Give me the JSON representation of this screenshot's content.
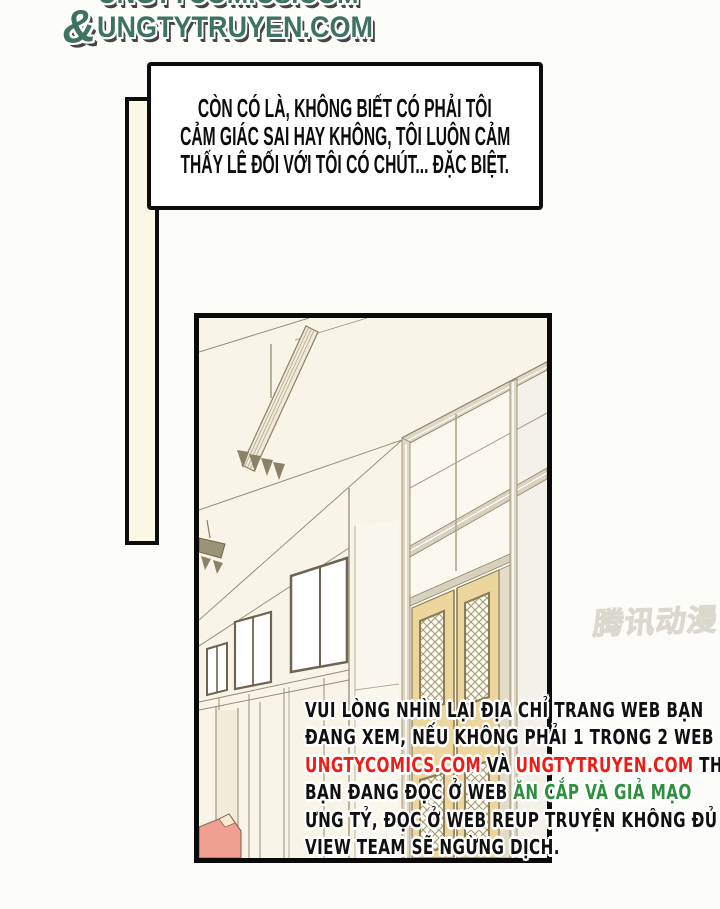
{
  "site_logo": {
    "top_line_partial": "UNGTYCOMICS.COM",
    "ampersand": "&",
    "main_line": "UNGTYTRUYEN.COM",
    "color": "#3e7262"
  },
  "speech_bubble": {
    "lines": [
      "CÒN CÓ LÀ, KHÔNG BIẾT CÓ PHẢI TÔI",
      "CẢM GIÁC SAI HAY KHÔNG, TÔI LUÔN CẢM",
      "THẤY LÊ ĐỐI VỚI TÔI CÓ CHÚT... ĐẶC BIỆT."
    ]
  },
  "artwork": {
    "watermark": "腾讯动漫",
    "wall_color": "#f8f5e8",
    "door_color": "#ecd69e",
    "floor_color": "#f0a090",
    "line_color": "#978d75"
  },
  "warning": {
    "lines": [
      {
        "segments": [
          {
            "text": "VUI LÒNG NHÌN LẠI ĐỊA CHỈ TRANG WEB BẠN",
            "color": "#101010"
          }
        ]
      },
      {
        "segments": [
          {
            "text": "ĐANG XEM, NẾU KHÔNG PHẢI 1 TRONG 2 WEB",
            "color": "#101010"
          }
        ]
      },
      {
        "segments": [
          {
            "text": "UNGTYCOMICS.COM",
            "color": "#ed1c16"
          },
          {
            "text": " VÀ ",
            "color": "#101010"
          },
          {
            "text": "UNGTYTRUYEN.COM",
            "color": "#ed1c16"
          },
          {
            "text": " THÌ",
            "color": "#101010"
          }
        ]
      },
      {
        "segments": [
          {
            "text": "BẠN ĐANG ĐỌC Ở WEB ",
            "color": "#101010"
          },
          {
            "text": "ĂN CẮP VÀ GIẢ MẠO",
            "color": "#2f8f3f"
          }
        ]
      },
      {
        "segments": [
          {
            "text": "ƯNG TỶ, ĐỌC Ở WEB REUP TRUYỆN KHÔNG ĐỦ",
            "color": "#101010"
          }
        ]
      },
      {
        "segments": [
          {
            "text": "VIEW TEAM SẼ NGỪNG DỊCH.",
            "color": "#101010"
          }
        ]
      }
    ]
  }
}
